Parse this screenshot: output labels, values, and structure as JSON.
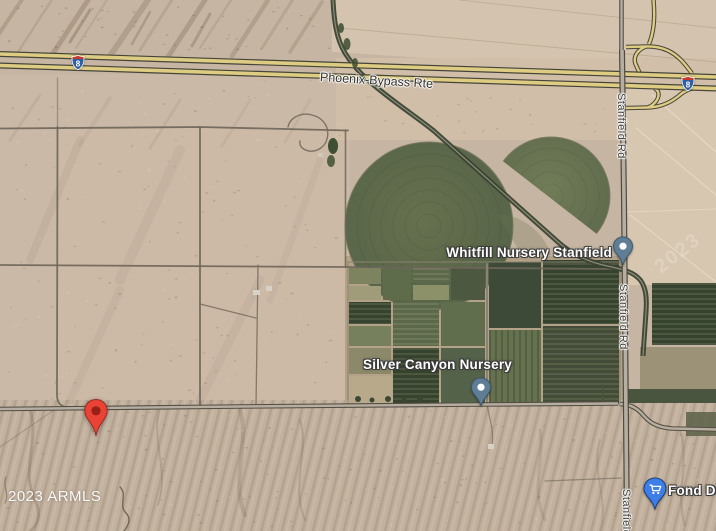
{
  "attribution": "2023 ARMLS",
  "watermark": "2023",
  "highway": {
    "name": "Phoenix-Bypass Rte",
    "shield_number": "8"
  },
  "roads": {
    "stanfield": "Stanfield Rd"
  },
  "pois": {
    "whitfill": {
      "label": "Whitfill Nursery Stanfield",
      "type": "place"
    },
    "silver_canyon": {
      "label": "Silver Canyon Nursery",
      "type": "place"
    },
    "fond_du": {
      "label": "Fond Du",
      "type": "shopping"
    }
  },
  "colors": {
    "marker_red": "#EA4335",
    "marker_red_dark": "#8F1D12",
    "poi_pin": "#5F7E96",
    "poi_pin_edge": "#3F5A6E",
    "shopping_pin": "#3D7EE8",
    "shopping_pin_edge": "#1C3F7A",
    "interstate_red": "#C5392F",
    "interstate_blue": "#2E5FA3",
    "highway_yellow": "#DDCC82",
    "crop_circle_green": "#66714F"
  }
}
